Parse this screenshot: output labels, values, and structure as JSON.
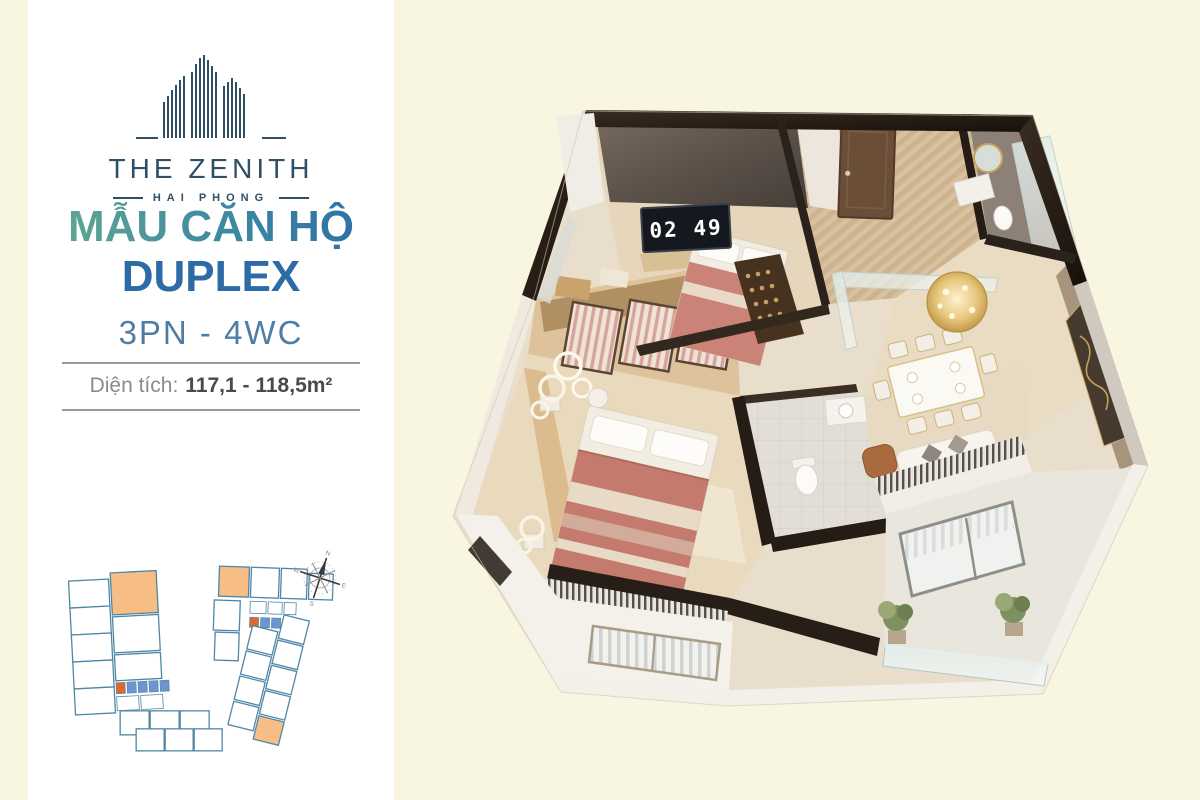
{
  "page": {
    "background": "#f8f5e1",
    "panel_background": "#ffffff"
  },
  "logo": {
    "name": "THE ZENITH",
    "subtitle": "HAI PHONG",
    "color": "#2e4f64"
  },
  "listing": {
    "title_line1": "MẪU CĂN HỘ",
    "title_line2": "DUPLEX",
    "config": "3PN - 4WC",
    "area_label": "Diện tích:",
    "area_value": "117,1 - 118,5m²",
    "title_gradient_start": "#68ab8e",
    "title_gradient_end": "#2c6ba5",
    "duplex_color": "#2d6ba6",
    "config_color": "#4f7da4"
  },
  "keyplan": {
    "outline_color": "#4e87a6",
    "highlight_color": "#f6bd85",
    "core_color": "#6f94cf",
    "stair_color": "#e0672f",
    "compass": {
      "n": "N",
      "e": "E",
      "s": "S",
      "w": "W"
    }
  },
  "render": {
    "clock": "02 49",
    "wall_color": "#261d16",
    "floor_color": "#d9c2a0",
    "bed_color": "#c57a6e",
    "gold_color": "#d4b06a"
  }
}
